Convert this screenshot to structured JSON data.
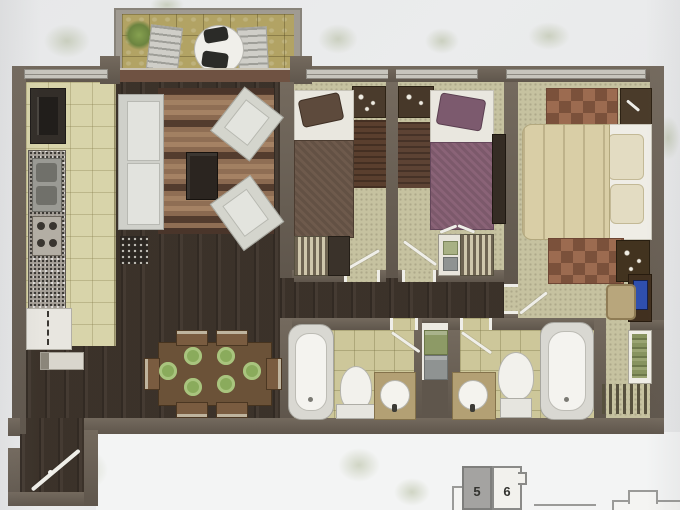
{
  "key_plan": {
    "units": [
      {
        "label": "5",
        "highlighted": true
      },
      {
        "label": "6",
        "highlighted": false
      }
    ]
  },
  "palette": {
    "paper": "#e9eaeb",
    "wall": "#6b6156",
    "wood-floor": "#3f352c",
    "kitchen-tile": "#d8d4aa",
    "carpet": "#c6c2a0",
    "bath-tile": "#cdc79a",
    "balcony-tile": "#b2a364",
    "rug-brown": "#5d4334",
    "bed-plum": "#8a6377",
    "bed-taupe": "#6e5a4c",
    "bed-cream": "#d9cea6",
    "plate-green": "#8aab5c",
    "tv-blue": "#2f4fae",
    "fixture-white": "#f0efe9",
    "unit-highlight": "#a4a3a1"
  },
  "rooms": {
    "balcony": {
      "furniture": [
        "plant",
        "lounge-chair",
        "lounge-chair",
        "round-table",
        "patio-chairs"
      ]
    },
    "kitchen": {
      "furniture": [
        "refrigerator",
        "double-sink",
        "cooktop",
        "granite-counter",
        "cabinet",
        "console"
      ]
    },
    "living-dining": {
      "furniture": [
        "sofa",
        "striped-rug",
        "coffee-table",
        "armchair",
        "armchair",
        "plant-basket",
        "dining-table",
        "six-chairs",
        "six-plates"
      ]
    },
    "bedroom-1": {
      "furniture": [
        "single-bed",
        "nightstand",
        "rug",
        "wardrobe"
      ]
    },
    "bedroom-2": {
      "furniture": [
        "single-bed",
        "nightstand",
        "rug",
        "dresser",
        "wardrobe"
      ]
    },
    "master-bedroom": {
      "furniture": [
        "double-bed",
        "nightstand",
        "nightstand",
        "checker-rug",
        "checker-rug",
        "desk",
        "tv",
        "chair",
        "closet",
        "clothes-rack"
      ]
    },
    "bathroom-1": {
      "furniture": [
        "bathtub",
        "toilet",
        "sink-vanity"
      ]
    },
    "bathroom-2": {
      "furniture": [
        "bathtub",
        "toilet",
        "sink-vanity"
      ]
    },
    "hallway": {
      "furniture": [
        "entry-door",
        "towel-shelf"
      ]
    }
  }
}
